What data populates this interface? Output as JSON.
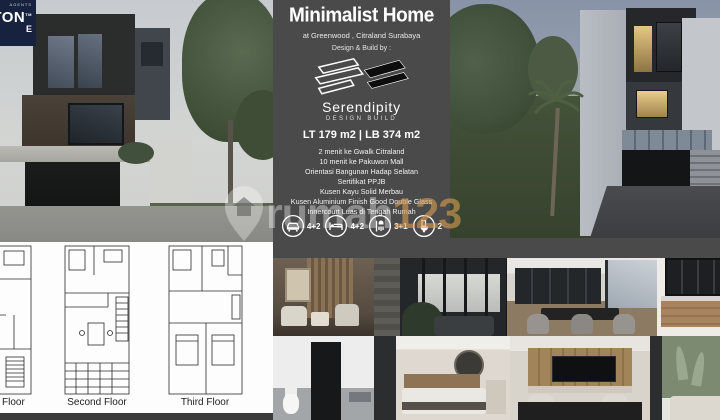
{
  "agency_badge": {
    "line1": "AGENTS",
    "line2": "TON",
    "tm": "TM",
    "line3": "E"
  },
  "info_panel": {
    "title": "Minimalist Home",
    "location": "at Greenwood , Citraland Surabaya",
    "design_by_label": "Design & Build by :",
    "studio": {
      "name": "Serendipity",
      "tagline": "DESIGN BUILD"
    },
    "area_line": "LT 179 m2  |  LB 374 m2",
    "features": [
      "2 menit ke Gwalk Citraland",
      "10 menit ke Pakuwon Mall",
      "Orientasi Bangunan Hadap Selatan",
      "Sertifikat PPJB",
      "Kusen Kayu Solid Merbau",
      "Kusen Aluminium Finish Good Double Glass",
      "Innercourt Luas di Tengah Rumah"
    ],
    "stats": [
      {
        "icon": "car-icon",
        "value": "4+2"
      },
      {
        "icon": "bed-icon",
        "value": "4+2"
      },
      {
        "icon": "shower-icon",
        "value": "3+1"
      },
      {
        "icon": "toilet-icon",
        "value": "2"
      }
    ]
  },
  "floor_plans": {
    "labels": [
      "Floor",
      "Second Floor",
      "Third Floor"
    ]
  },
  "watermark": {
    "prefix": "rumah",
    "suffix": "123"
  },
  "colors": {
    "panel_bg": "#4a4a4a",
    "watermark_accent": "#d69b52",
    "badge_bg": "#17233e"
  }
}
